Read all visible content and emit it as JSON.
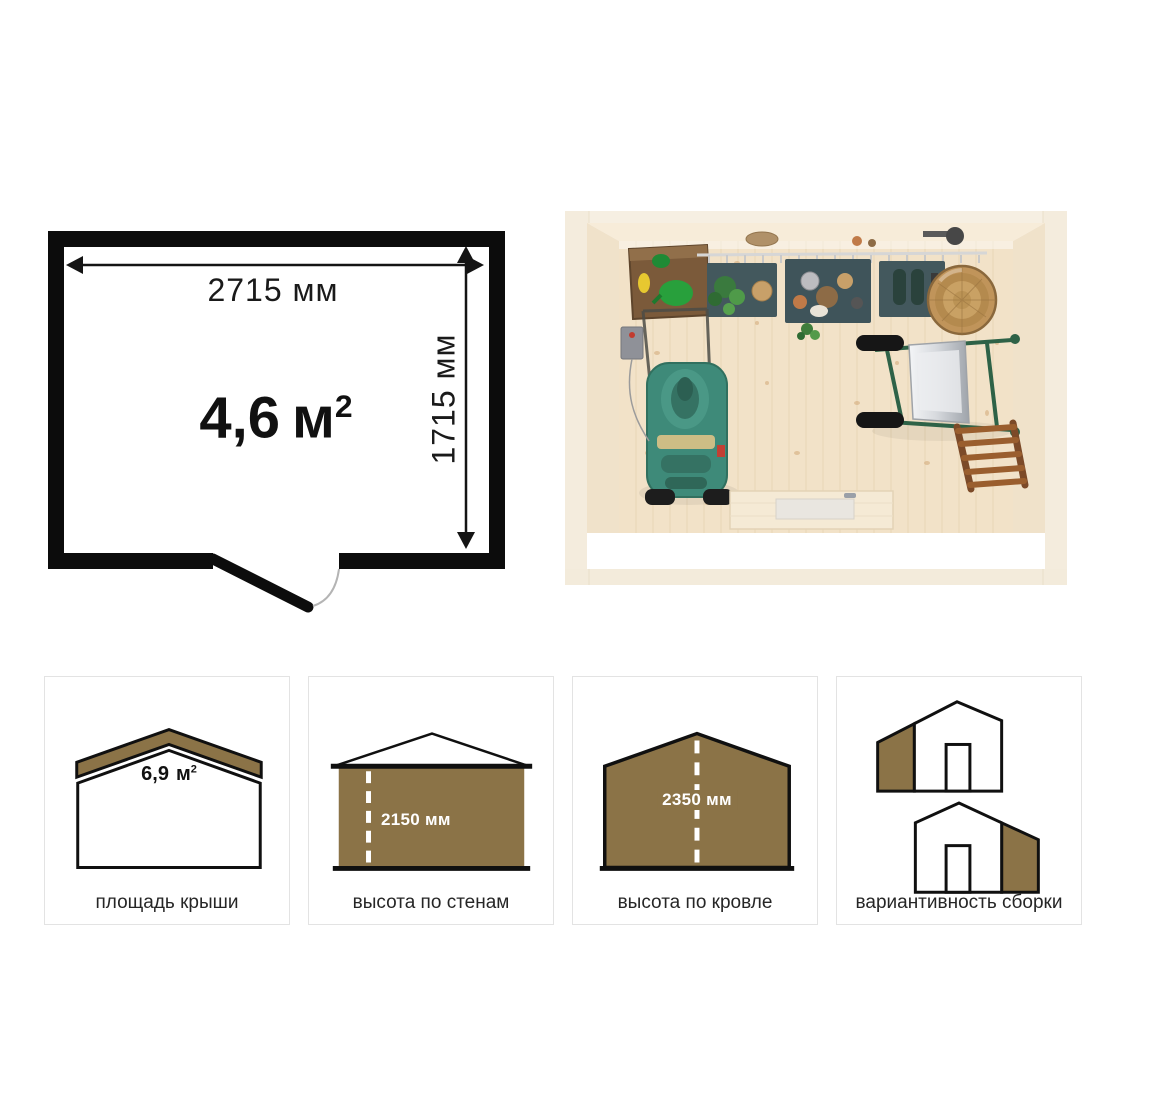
{
  "floor_plan": {
    "width_label": "2715 мм",
    "height_label": "1715 мм",
    "area_value": "4,6",
    "area_unit": "м",
    "area_sup": "2"
  },
  "photo": {
    "objects": [
      "cabinet",
      "tool-rack",
      "barrel",
      "lawnmower",
      "wheelbarrow",
      "ladder",
      "door-threshold"
    ]
  },
  "cards": [
    {
      "label": "площадь крыши",
      "value": "6,9",
      "unit": "м",
      "sup": "2",
      "icon": "roof-area-icon"
    },
    {
      "label": "высота по стенам",
      "value": "2150 мм",
      "icon": "wall-height-icon"
    },
    {
      "label": "высота по кровле",
      "value": "2350 мм",
      "icon": "roof-height-icon"
    },
    {
      "label": "вариантивность сборки",
      "icon": "assembly-variants-icon"
    }
  ],
  "colors": {
    "accent_brown": "#8B7347",
    "plan_black": "#0C0C0C",
    "card_border": "#E3E3E3",
    "label_text": "#262626",
    "value_white": "#FFFFFF"
  }
}
